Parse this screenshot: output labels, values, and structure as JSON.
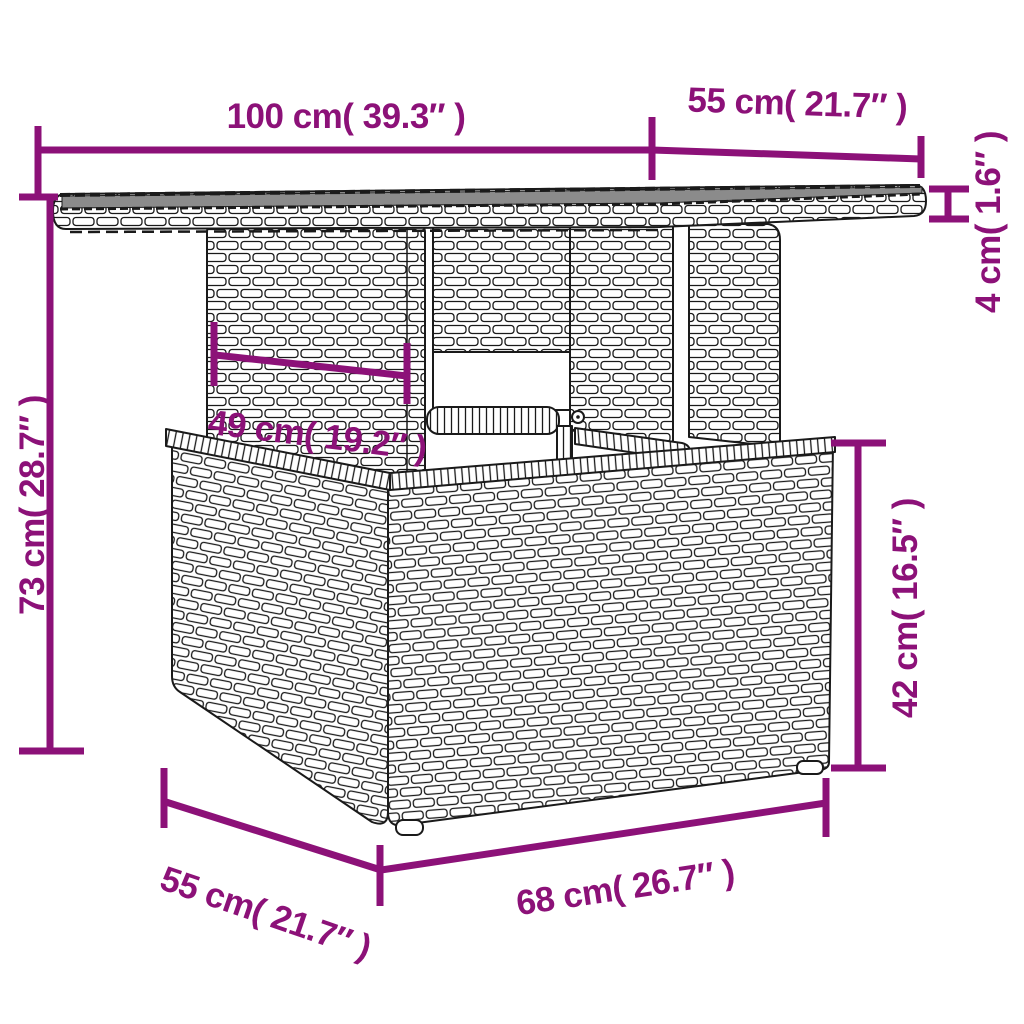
{
  "figure": {
    "type": "product-dimension-diagram",
    "subject": "poly rattan garden table with glass top"
  },
  "colors": {
    "accent": "#8C1178",
    "outline": "#1a1a1a",
    "glass": "#8b8b8b",
    "background": "#ffffff"
  },
  "dimensions": {
    "top_width": {
      "label": "100 cm( 39.3″ )",
      "cm": 100,
      "inch": 39.3
    },
    "top_depth": {
      "label": "55 cm( 21.7″ )",
      "cm": 55,
      "inch": 21.7
    },
    "top_thickness": {
      "label": "4 cm( 1.6″ )",
      "cm": 4,
      "inch": 1.6
    },
    "overall_height": {
      "label": "73 cm( 28.7″ )",
      "cm": 73,
      "inch": 28.7
    },
    "pedestal_width": {
      "label": "49 cm( 19.2″ )",
      "cm": 49,
      "inch": 19.2
    },
    "base_height": {
      "label": "42 cm( 16.5″ )",
      "cm": 42,
      "inch": 16.5
    },
    "base_width": {
      "label": "68 cm( 26.7″ )",
      "cm": 68,
      "inch": 26.7
    },
    "base_depth": {
      "label": "55 cm( 21.7″ )",
      "cm": 55,
      "inch": 21.7
    }
  }
}
